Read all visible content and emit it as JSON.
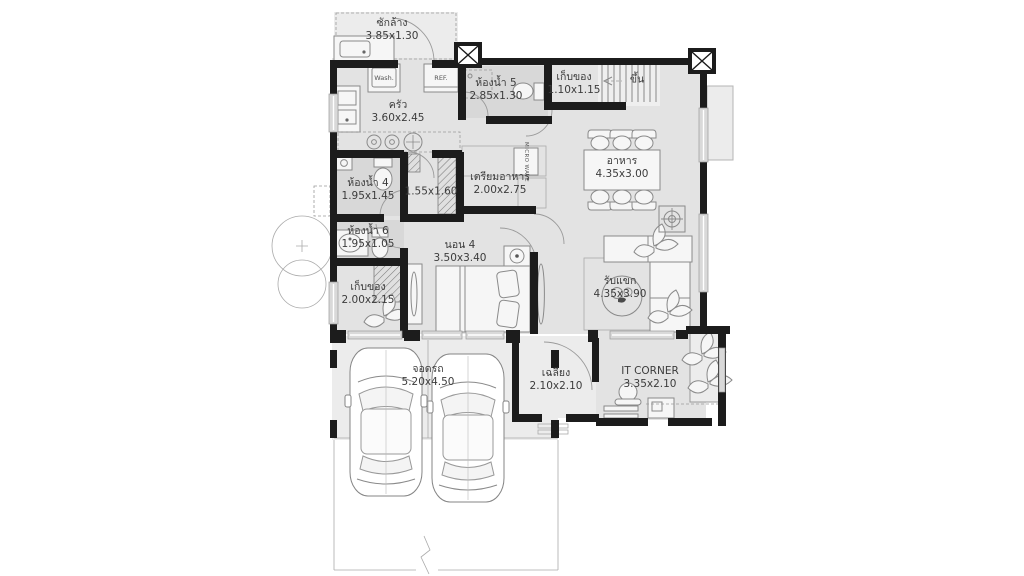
{
  "plan_title": "house-floor-plan",
  "rooms": {
    "laundry": {
      "name": "ซักล้าง",
      "dim": "3.85x1.30"
    },
    "kitchen": {
      "name": "ครัว",
      "dim": "3.60x2.45"
    },
    "bath5": {
      "name": "ห้องน้ำ 5",
      "dim": "2.85x1.30"
    },
    "store_top": {
      "name": "เก็บของ",
      "dim": "1.10x1.15"
    },
    "dining": {
      "name": "อาหาร",
      "dim": "4.35x3.00"
    },
    "bath4": {
      "name": "ห้องน้ำ 4",
      "dim": "1.95x1.45"
    },
    "hall": {
      "dim": "1.55x1.60"
    },
    "prep": {
      "name": "เตรียมอาหาร",
      "dim": "2.00x2.75"
    },
    "bath6": {
      "name": "ห้องน้ำ 6",
      "dim": "1.95x1.05"
    },
    "store_mid": {
      "name": "เก็บของ",
      "dim": "2.00x2.15"
    },
    "bed4": {
      "name": "นอน 4",
      "dim": "3.50x3.40"
    },
    "living": {
      "name": "รับแขก",
      "dim": "4.35x3.90"
    },
    "it_corner": {
      "name": "IT CORNER",
      "dim": "3.35x2.10"
    },
    "porch": {
      "name": "เฉลียง",
      "dim": "2.10x2.10"
    },
    "parking": {
      "name": "จอดรถ",
      "dim": "5.20x4.50"
    }
  },
  "stairs": {
    "label": "ขึ้น"
  },
  "appliances": {
    "washer": "Wash.",
    "fridge": "REF.",
    "microwave": "MICRO WAVE"
  },
  "colors": {
    "wall": "#1c1c1c",
    "room_fill": "#e3e3e3",
    "bath_fill": "#d8d8d8",
    "line": "#8a8a8a"
  }
}
